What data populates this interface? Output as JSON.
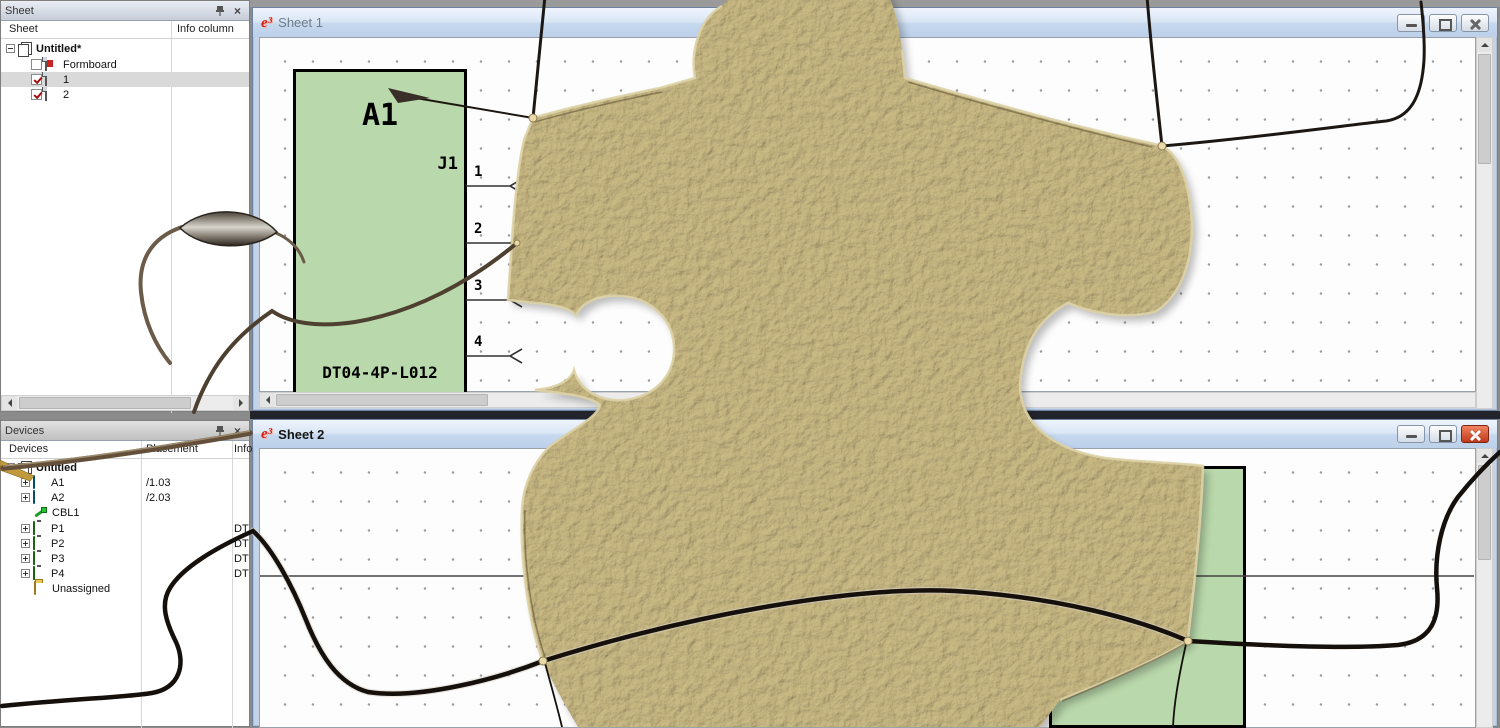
{
  "app_icon": "e³",
  "colors": {
    "block_fill": "#b9d8ab",
    "block_border": "#000000",
    "cardboard": "#a89868",
    "thread_dark": "#1a140f",
    "thread_brown": "#5f4f3a",
    "active_close_red": "#c03a1a",
    "selection_gray": "#d9d9d9"
  },
  "sheet_panel": {
    "title": "Sheet",
    "columns": [
      "Sheet",
      "Info column"
    ],
    "root_label": "Untitled*",
    "rows": [
      {
        "label": "Formboard",
        "checked": false
      },
      {
        "label": "1",
        "checked": true,
        "selected": true
      },
      {
        "label": "2",
        "checked": true
      }
    ]
  },
  "devices_panel": {
    "title": "Devices",
    "columns": [
      "Devices",
      "Placement",
      "Info column"
    ],
    "root_label": "Untitled",
    "rows": [
      {
        "label": "A1",
        "placement": "/1.03",
        "info": ""
      },
      {
        "label": "A2",
        "placement": "/2.03",
        "info": ""
      },
      {
        "label": "CBL1",
        "placement": "",
        "info": ""
      },
      {
        "label": "P1",
        "placement": "",
        "info": "DT"
      },
      {
        "label": "P2",
        "placement": "",
        "info": "DT"
      },
      {
        "label": "P3",
        "placement": "",
        "info": "DT"
      },
      {
        "label": "P4",
        "placement": "",
        "info": "DT"
      },
      {
        "label": "Unassigned",
        "placement": "",
        "info": ""
      }
    ]
  },
  "window1": {
    "title": "Sheet 1",
    "block": {
      "designator": "A1",
      "connector": "J1",
      "part_number": "DT04-4P-L012"
    },
    "pins": [
      "1",
      "2",
      "3",
      "4"
    ]
  },
  "window2": {
    "title": "Sheet 2",
    "pins": [
      "2",
      "3"
    ]
  }
}
